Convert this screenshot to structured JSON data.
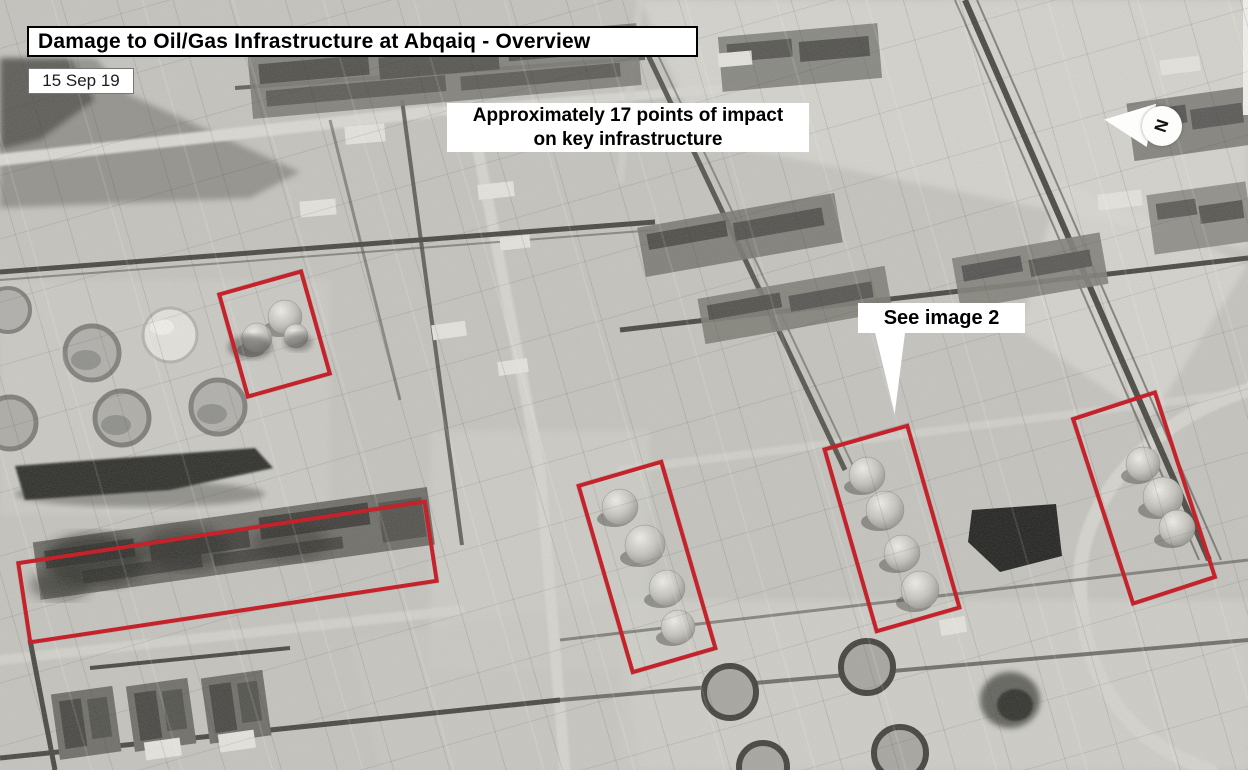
{
  "header": {
    "title": "Damage to Oil/Gas Infrastructure at Abqaiq - Overview",
    "date": "15 Sep 19"
  },
  "annotations": {
    "impact_note_line1": "Approximately 17 points of impact",
    "impact_note_line2": "on key infrastructure",
    "see_image_label": "See image 2",
    "compass_label": "N"
  },
  "colors": {
    "annotation_red": "#c5232b",
    "label_background": "#ffffff",
    "label_text": "#000000"
  },
  "impact_areas": [
    {
      "id": "area-1",
      "cx": 274,
      "cy": 334,
      "width": 89,
      "height": 110,
      "angle": -15.7
    },
    {
      "id": "area-2",
      "cx": 227,
      "cy": 572,
      "width": 415,
      "height": 84,
      "angle": -8.6
    },
    {
      "id": "area-3",
      "cx": 647,
      "cy": 567,
      "width": 90,
      "height": 198,
      "angle": -16.2
    },
    {
      "id": "area-4",
      "cx": 892,
      "cy": 528,
      "width": 90,
      "height": 193,
      "angle": -16.0
    },
    {
      "id": "area-5",
      "cx": 1144,
      "cy": 498,
      "width": 90,
      "height": 198,
      "angle": -18.0
    }
  ]
}
